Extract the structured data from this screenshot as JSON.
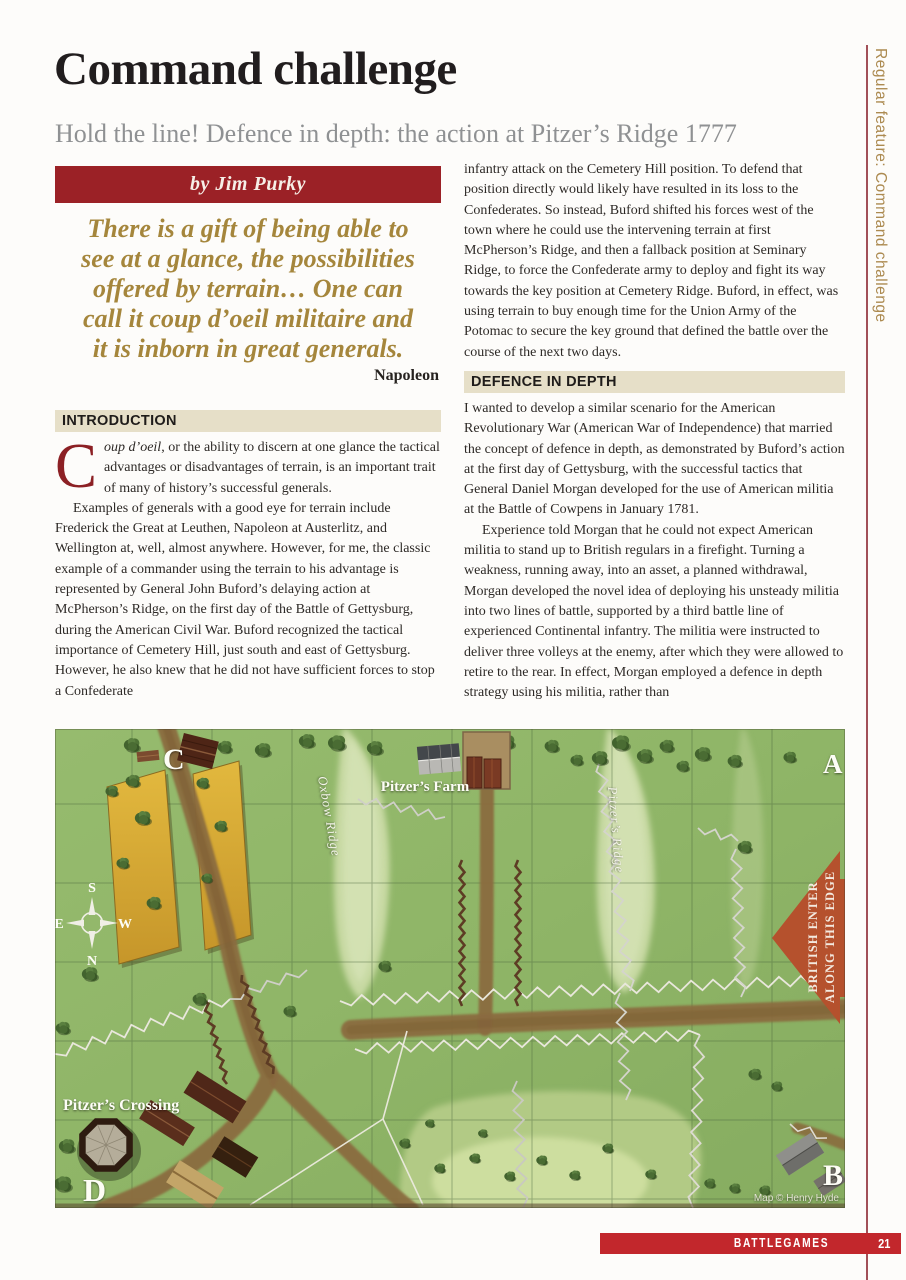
{
  "page": {
    "title": "Command challenge",
    "subtitle": "Hold the line! Defence in depth: the action at Pitzer’s Ridge 1777"
  },
  "sidebar": {
    "vertical_label": "Regular feature: Command challenge"
  },
  "byline": {
    "text": "by Jim Purky"
  },
  "quote": {
    "lines": [
      "There is a gift of being able to",
      "see at a glance, the possibilities",
      "offered by terrain… One can",
      "call it coup d’oeil militaire and",
      "it is inborn in great generals."
    ],
    "attribution": "Napoleon"
  },
  "sections": {
    "introduction": {
      "heading": "INTRODUCTION",
      "dropcap": "C",
      "lead_italic": "oup d’oeil",
      "lead_rest": ", or the ability to discern at one glance the tactical advantages or disadvantages of terrain, is an important trait of many of history’s successful generals.",
      "p2": "Examples of generals with a good eye for terrain include Frederick the Great at Leuthen, Napoleon at Austerlitz, and Wellington at, well, almost anywhere. However, for me, the classic example of a commander using the terrain to his advantage is represented by General John Buford’s delaying action at McPherson’s Ridge, on the first day of the Battle of Gettysburg, during the American Civil War. Buford recognized the tactical importance of Cemetery Hill, just south and east of Gettysburg. However, he also knew that he did not have sufficient forces to stop a Confederate"
    },
    "column2": {
      "p1": "infantry attack on the Cemetery Hill position. To defend that position directly would likely have resulted in its loss to the Confederates. So instead, Buford shifted his forces west of the town where he could use the intervening terrain at first McPherson’s Ridge, and then a fallback position at Seminary Ridge, to force the Confederate army to deploy and fight its way towards the key position at Cemetery Ridge. Buford, in effect, was using terrain to buy enough time for the Union Army of the Potomac to secure the key ground that defined the battle over the course of the next two days."
    },
    "defence": {
      "heading": "DEFENCE IN DEPTH",
      "p1": "I wanted to develop a similar scenario for the American Revolutionary War (American War of Independence) that married the concept of defence in depth, as demonstrated by Buford’s action at the first day of Gettysburg, with the successful tactics that General Daniel Morgan developed for the use of American militia at the Battle of Cowpens in January 1781.",
      "p2": "Experience told Morgan that he could not expect American militia to stand up to British regulars in a firefight. Turning a weakness, running away, into an asset, a planned withdrawal, Morgan developed the novel idea of deploying his unsteady militia into two lines of battle, supported by a third battle line of experienced Continental infantry. The militia were instructed to deliver three volleys at the enemy, after which they were allowed to retire to the rear. In effect, Morgan employed a defence in depth strategy using his militia, rather than"
    }
  },
  "map": {
    "corners": {
      "a": "A",
      "b": "B",
      "c": "C",
      "d": "D"
    },
    "labels": {
      "farm": "Pitzer’s Farm",
      "crossing": "Pitzer’s Crossing",
      "oxbow": "Oxbow Ridge",
      "ridge": "Pitzer’s Ridge"
    },
    "arrow": {
      "line1": "BRITISH ENTER",
      "line2": "ALONG THIS EDGE",
      "color": "#b5512d"
    },
    "compass": {
      "n": "N",
      "s": "S",
      "e": "E",
      "w": "W"
    },
    "credit": "Map © Henry Hyde"
  },
  "footer": {
    "magazine": "BATTLEGAMES",
    "page_number": "21",
    "bar_color": "#c2272c"
  },
  "colors": {
    "banner_red": "#9b2126",
    "quote_gold": "#a5863c",
    "section_bg": "#e6dfc8",
    "dropcap_red": "#8c2024",
    "sidebar_text": "#ac8a50",
    "rule_red": "#a25058",
    "map_green": "#8fb567",
    "field_gold": "#d9a934",
    "arrow_red": "#b5512d"
  }
}
